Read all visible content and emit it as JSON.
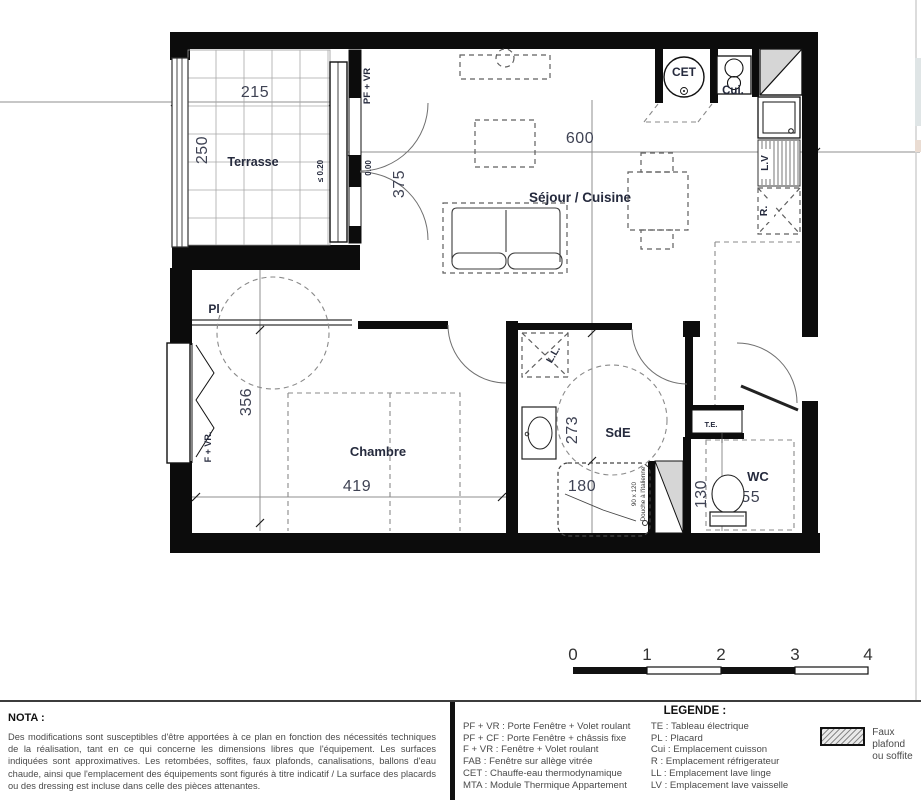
{
  "plan": {
    "rooms": {
      "terrasse": "Terrasse",
      "sejour": "Séjour / Cuisine",
      "chambre": "Chambre",
      "sde": "SdE",
      "wc": "WC"
    },
    "dimensions": {
      "terrasse_w": "215",
      "terrasse_d": "250",
      "sejour_w": "600",
      "sejour_d": "375",
      "chambre_w": "419",
      "chambre_d": "356",
      "sde_d": "273",
      "sde_w": "180",
      "wc_d": "130",
      "wc_w": "155"
    },
    "annotations": {
      "pf_vr": "PF + VR",
      "level": "0.00",
      "threshold": "≤ 0.20",
      "placard": "Pl",
      "f_vr": "F + VR.",
      "cet": "CET",
      "cui": "Cui.",
      "lv": "L.V",
      "r": "R.",
      "ll": "L.L.",
      "te": "T.E.",
      "shower_size": "90 x 120",
      "shower_type": "Douche à l'italienne"
    }
  },
  "scale_bar": {
    "ticks": [
      "0",
      "1",
      "2",
      "3",
      "4"
    ]
  },
  "nota": {
    "title": "NOTA :",
    "body": "Des modifications sont susceptibles d'être apportées à ce plan en fonction des nécessités techniques de la réalisation, tant en ce qui concerne les dimensions libres que l'équipement. Les surfaces indiquées sont approximatives. Les retombées, soffites, faux plafonds, canalisations, ballons d'eau chaude, ainsi que l'emplacement des équipements sont figurés à titre indicatif / La surface des placards ou des dressing est incluse dans celle des pièces attenantes."
  },
  "legend": {
    "title": "LEGENDE :",
    "items_left": [
      "PF + VR : Porte Fenêtre + Volet roulant",
      "PF + CF : Porte Fenêtre + châssis fixe",
      "F + VR : Fenêtre + Volet roulant",
      "FAB : Fenêtre sur allège vitrée",
      "CET : Chauffe-eau thermodynamique",
      "MTA : Module Thermique Appartement"
    ],
    "items_right": [
      "TE : Tableau électrique",
      "PL : Placard",
      "Cui : Emplacement cuisson",
      "R : Emplacement réfrigerateur",
      "LL : Emplacement lave linge",
      "LV : Emplacement lave vaisselle"
    ],
    "swatch": {
      "line1": "Faux plafond",
      "line2": "ou soffite"
    }
  }
}
